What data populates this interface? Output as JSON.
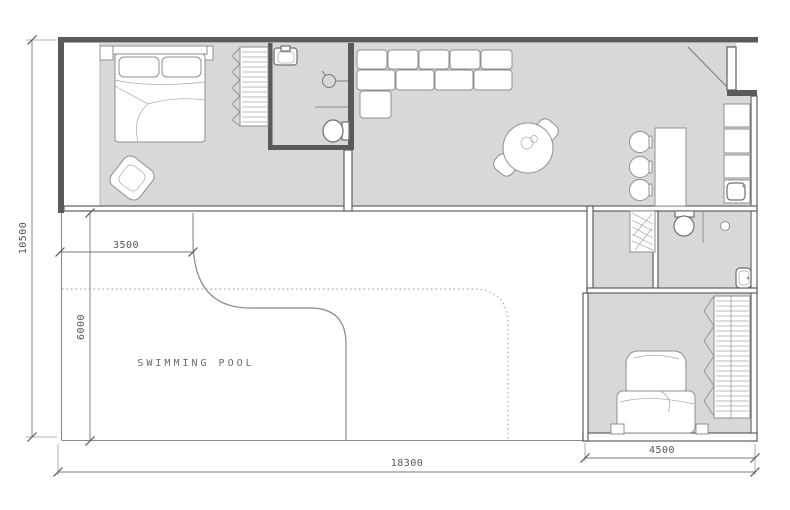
{
  "labels": {
    "swimming_pool": "SWIMMING POOL"
  },
  "dimensions": {
    "height_total": "10500",
    "pool_width": "3500",
    "pool_depth": "6000",
    "width_total": "18300",
    "bedroom_width": "4500"
  },
  "colors": {
    "background": "#ffffff",
    "floor_fill": "#d8d8d8",
    "wall_line": "#5f5f5f",
    "furniture_line": "#8f8f8f",
    "dimension_text": "#555555",
    "pool_dotted_line": "#aaaaaa"
  }
}
